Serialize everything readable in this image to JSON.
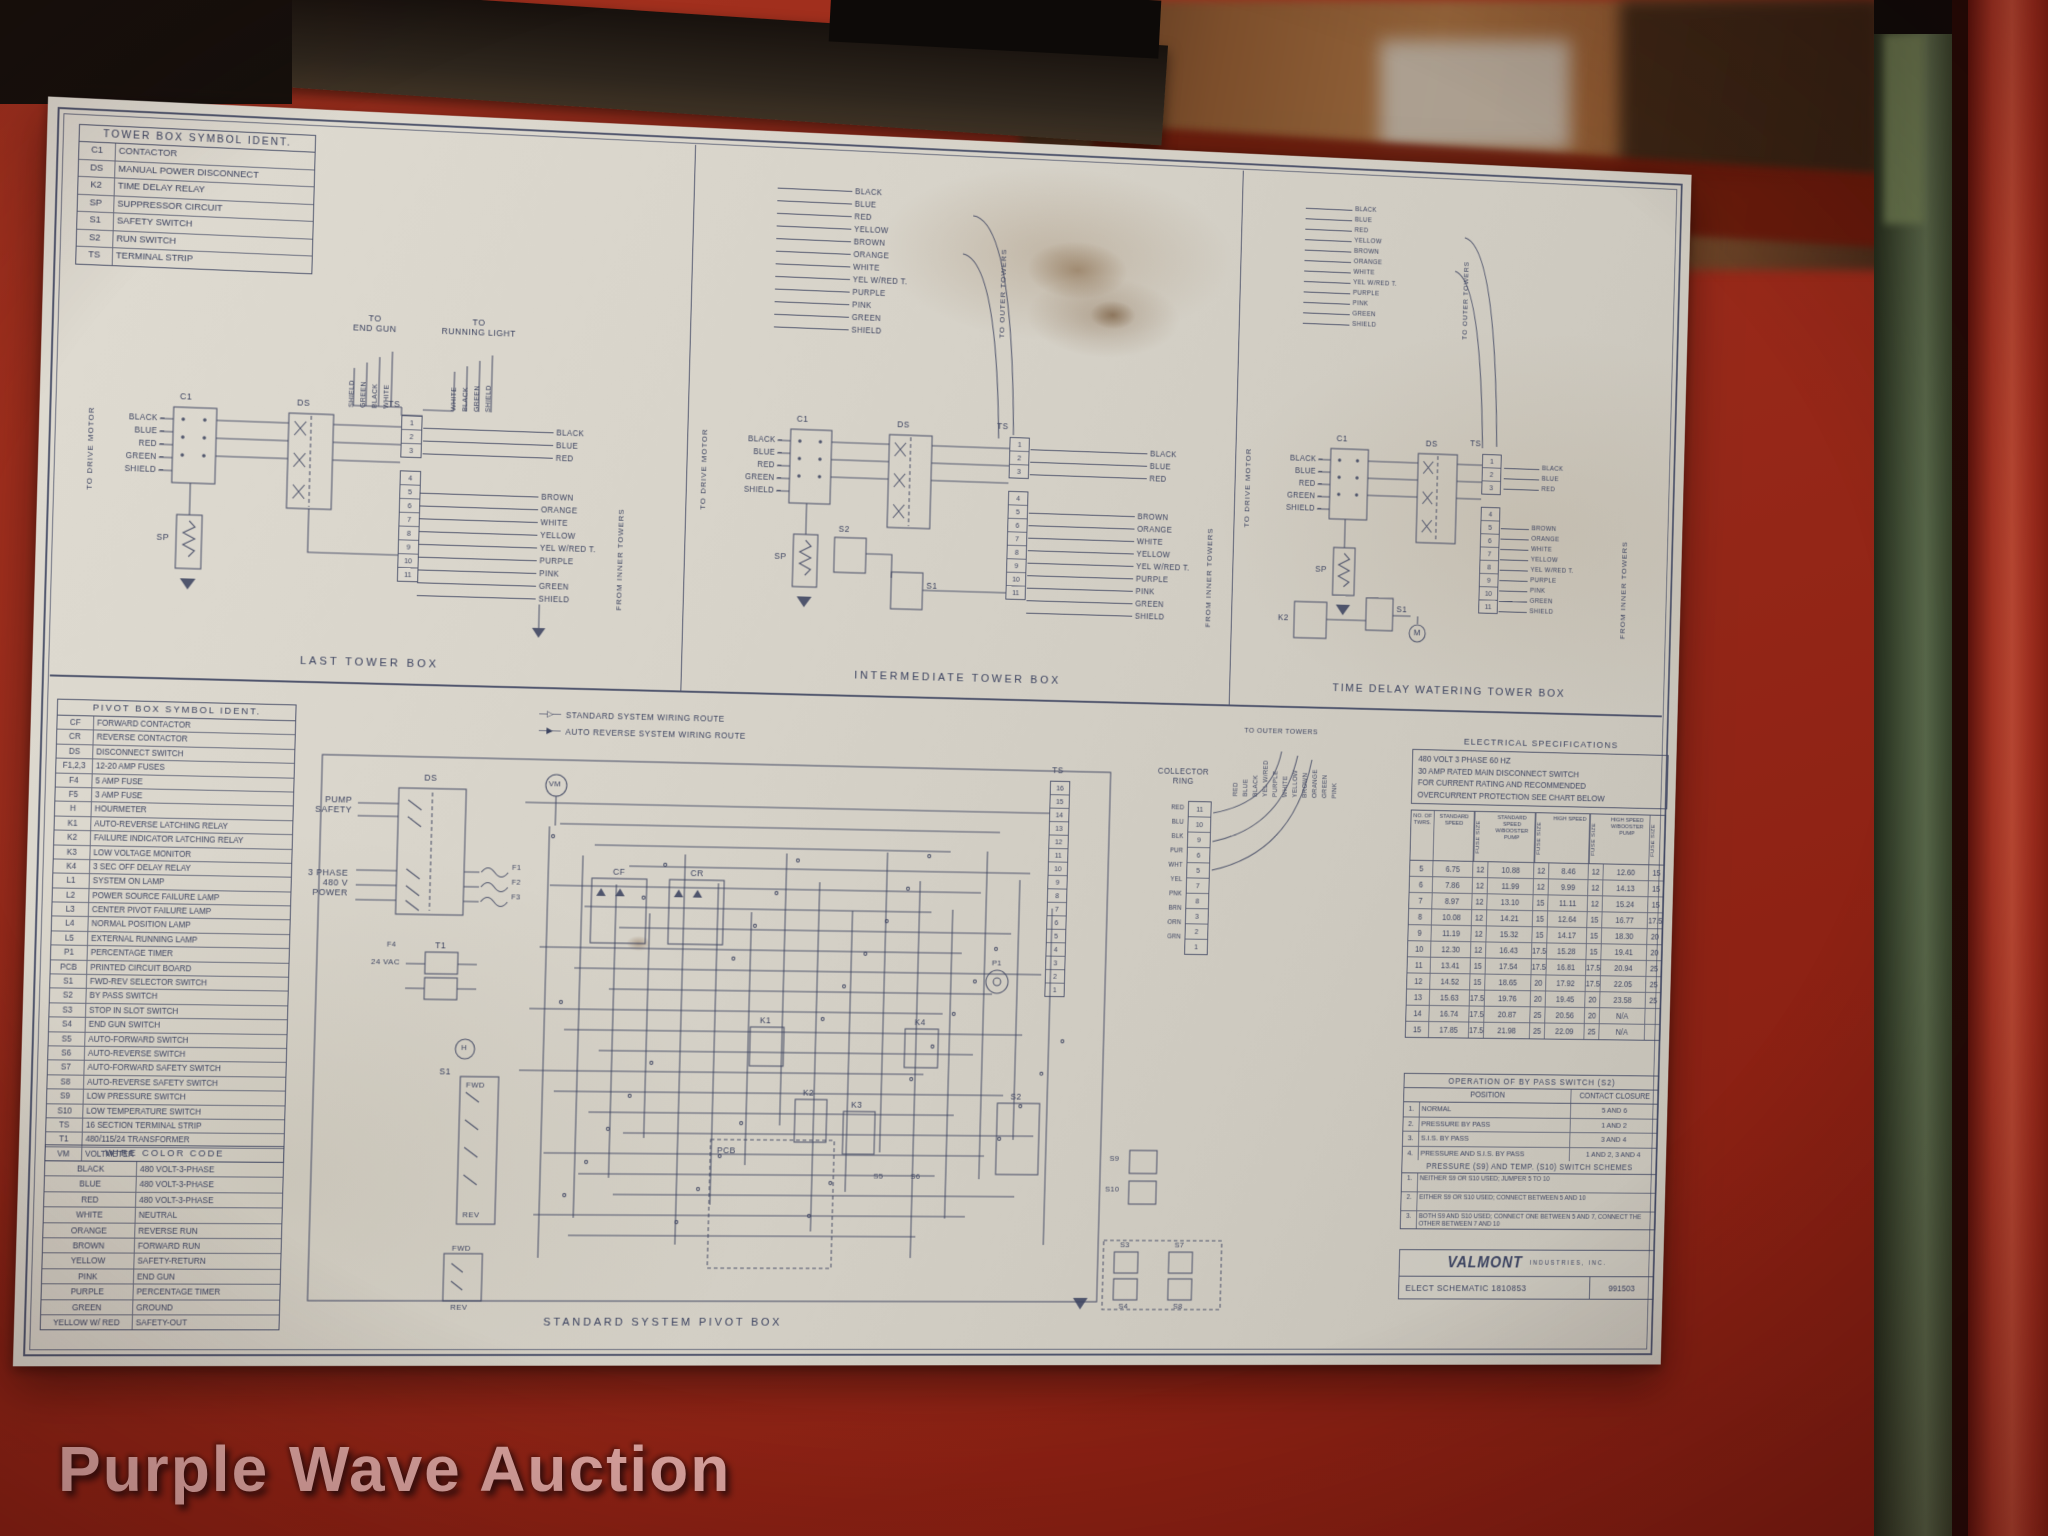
{
  "watermark": "Purple Wave Auction",
  "tower_symbol_table": {
    "title": "TOWER BOX SYMBOL IDENT.",
    "rows": [
      [
        "C1",
        "CONTACTOR"
      ],
      [
        "DS",
        "MANUAL POWER DISCONNECT"
      ],
      [
        "K2",
        "TIME DELAY RELAY"
      ],
      [
        "SP",
        "SUPPRESSOR CIRCUIT"
      ],
      [
        "S1",
        "SAFETY SWITCH"
      ],
      [
        "S2",
        "RUN SWITCH"
      ],
      [
        "TS",
        "TERMINAL STRIP"
      ]
    ]
  },
  "pivot_symbol_table": {
    "title": "PIVOT BOX SYMBOL IDENT.",
    "rows": [
      [
        "CF",
        "FORWARD CONTACTOR"
      ],
      [
        "CR",
        "REVERSE CONTACTOR"
      ],
      [
        "DS",
        "DISCONNECT SWITCH"
      ],
      [
        "F1,2,3",
        "12-20 AMP FUSES"
      ],
      [
        "F4",
        "5 AMP FUSE"
      ],
      [
        "F5",
        "3 AMP FUSE"
      ],
      [
        "H",
        "HOURMETER"
      ],
      [
        "K1",
        "AUTO-REVERSE LATCHING RELAY"
      ],
      [
        "K2",
        "FAILURE INDICATOR LATCHING RELAY"
      ],
      [
        "K3",
        "LOW VOLTAGE MONITOR"
      ],
      [
        "K4",
        "3 SEC OFF DELAY RELAY"
      ],
      [
        "L1",
        "SYSTEM ON LAMP"
      ],
      [
        "L2",
        "POWER SOURCE FAILURE LAMP"
      ],
      [
        "L3",
        "CENTER PIVOT FAILURE LAMP"
      ],
      [
        "L4",
        "NORMAL POSITION LAMP"
      ],
      [
        "L5",
        "EXTERNAL RUNNING LAMP"
      ],
      [
        "P1",
        "PERCENTAGE TIMER"
      ],
      [
        "PCB",
        "PRINTED CIRCUIT BOARD"
      ],
      [
        "S1",
        "FWD-REV SELECTOR SWITCH"
      ],
      [
        "S2",
        "BY PASS SWITCH"
      ],
      [
        "S3",
        "STOP IN SLOT SWITCH"
      ],
      [
        "S4",
        "END GUN SWITCH"
      ],
      [
        "S5",
        "AUTO-FORWARD SWITCH"
      ],
      [
        "S6",
        "AUTO-REVERSE SWITCH"
      ],
      [
        "S7",
        "AUTO-FORWARD SAFETY SWITCH"
      ],
      [
        "S8",
        "AUTO-REVERSE SAFETY SWITCH"
      ],
      [
        "S9",
        "LOW PRESSURE SWITCH"
      ],
      [
        "S10",
        "LOW TEMPERATURE SWITCH"
      ],
      [
        "TS",
        "16 SECTION TERMINAL STRIP"
      ],
      [
        "T1",
        "480/115/24 TRANSFORMER"
      ],
      [
        "VM",
        "VOLTMETER"
      ]
    ]
  },
  "wire_color_table": {
    "title": "WIRE COLOR CODE",
    "rows": [
      [
        "BLACK",
        "480 VOLT-3-PHASE"
      ],
      [
        "BLUE",
        "480 VOLT-3-PHASE"
      ],
      [
        "RED",
        "480 VOLT-3-PHASE"
      ],
      [
        "WHITE",
        "NEUTRAL"
      ],
      [
        "ORANGE",
        "REVERSE RUN"
      ],
      [
        "BROWN",
        "FORWARD RUN"
      ],
      [
        "YELLOW",
        "SAFETY-RETURN"
      ],
      [
        "PINK",
        "END GUN"
      ],
      [
        "PURPLE",
        "PERCENTAGE TIMER"
      ],
      [
        "GREEN",
        "GROUND"
      ],
      [
        "YELLOW W/ RED",
        "SAFETY-OUT"
      ]
    ]
  },
  "d1": {
    "caption": "LAST TOWER BOX",
    "to_drive_motor": "TO DRIVE MOTOR",
    "motor_wires": [
      "BLACK",
      "BLUE",
      "RED",
      "GREEN",
      "SHIELD"
    ],
    "c1": "C1",
    "ds": "DS",
    "ts": "TS",
    "sp": "SP",
    "to_end_gun": "TO\nEND GUN",
    "end_gun_wires": [
      "SHIELD",
      "GREEN",
      "BLACK",
      "WHITE"
    ],
    "to_running_light": "TO\nRUNNING LIGHT",
    "running_light_wires": [
      "WHITE",
      "BLACK",
      "GREEN",
      "SHIELD"
    ],
    "ts_top": [
      "1",
      "2",
      "3"
    ],
    "ts_bottom": [
      "4",
      "5",
      "6",
      "7",
      "8",
      "9",
      "10",
      "11"
    ],
    "phase_wires": [
      "BLACK",
      "BLUE",
      "RED"
    ],
    "tower_wires": [
      "BROWN",
      "ORANGE",
      "WHITE",
      "YELLOW",
      "YEL W/RED T.",
      "PURPLE",
      "PINK",
      "GREEN",
      "SHIELD"
    ],
    "from_inner_towers": "FROM INNER TOWERS"
  },
  "d2": {
    "caption": "INTERMEDIATE TOWER BOX",
    "to_drive_motor": "TO DRIVE MOTOR",
    "motor_wires": [
      "BLACK",
      "BLUE",
      "RED",
      "GREEN",
      "SHIELD"
    ],
    "c1": "C1",
    "ds": "DS",
    "ts": "TS",
    "sp": "SP",
    "s1": "S1",
    "s2": "S2",
    "outer_wires": [
      "BLACK",
      "BLUE",
      "RED",
      "YELLOW",
      "BROWN",
      "ORANGE",
      "WHITE",
      "YEL W/RED T.",
      "PURPLE",
      "PINK",
      "GREEN",
      "SHIELD"
    ],
    "to_outer_towers": "TO OUTER TOWERS",
    "ts_top": [
      "1",
      "2",
      "3"
    ],
    "ts_bottom": [
      "4",
      "5",
      "6",
      "7",
      "8",
      "9",
      "10",
      "11"
    ],
    "phase_wires": [
      "BLACK",
      "BLUE",
      "RED"
    ],
    "tower_wires": [
      "BROWN",
      "ORANGE",
      "WHITE",
      "YELLOW",
      "YEL W/RED T.",
      "PURPLE",
      "PINK",
      "GREEN",
      "SHIELD"
    ],
    "from_inner_towers": "FROM INNER TOWERS"
  },
  "d3": {
    "caption": "TIME DELAY WATERING TOWER BOX",
    "to_drive_motor": "TO DRIVE MOTOR",
    "motor_wires": [
      "BLACK",
      "BLUE",
      "RED",
      "GREEN",
      "SHIELD"
    ],
    "c1": "C1",
    "ds": "DS",
    "ts": "TS",
    "sp": "SP",
    "s1": "S1",
    "k2": "K2",
    "m": "M",
    "outer_wires": [
      "BLACK",
      "BLUE",
      "RED",
      "YELLOW",
      "BROWN",
      "ORANGE",
      "WHITE",
      "YEL W/RED T.",
      "PURPLE",
      "PINK",
      "GREEN",
      "SHIELD"
    ],
    "to_outer_towers": "TO OUTER TOWERS",
    "ts_top": [
      "1",
      "2",
      "3"
    ],
    "ts_bottom": [
      "4",
      "5",
      "6",
      "7",
      "8",
      "9",
      "10",
      "11"
    ],
    "phase_wires": [
      "BLACK",
      "BLUE",
      "RED"
    ],
    "tower_wires": [
      "BROWN",
      "ORANGE",
      "WHITE",
      "YELLOW",
      "YEL W/RED T.",
      "PURPLE",
      "PINK",
      "GREEN",
      "SHIELD"
    ],
    "from_inner_towers": "FROM INNER TOWERS"
  },
  "pv": {
    "caption": "STANDARD SYSTEM PIVOT BOX",
    "legend_std": "STANDARD SYSTEM WIRING ROUTE",
    "legend_auto": "AUTO REVERSE SYSTEM WIRING ROUTE",
    "pump_safety": "PUMP\nSAFETY",
    "power": "3 PHASE\n480 V\nPOWER",
    "ds": "DS",
    "f1": "F1",
    "f2": "F2",
    "f3": "F3",
    "f4": "F4",
    "vm": "VM",
    "cf": "CF",
    "cr": "CR",
    "t1": "T1",
    "vac24": "24 VAC",
    "h": "H",
    "s1": "S1",
    "fwd": "FWD",
    "rev": "REV",
    "pcb": "PCB",
    "k1": "K1",
    "k2": "K2",
    "k3": "K3",
    "k4": "K4",
    "p1": "P1",
    "s2": "S2",
    "s3": "S3",
    "s4": "S4",
    "s5": "S5",
    "s6": "S6",
    "s7": "S7",
    "s8": "S8",
    "s9": "S9",
    "s10": "S10",
    "ts": "TS",
    "collector": "COLLECTOR\nRING",
    "collector_wires": [
      "RED",
      "BLU",
      "BLK",
      "PUR",
      "WHT",
      "YEL",
      "PNK",
      "BRN",
      "ORN",
      "GRN"
    ],
    "collector_terms": [
      "11",
      "10",
      "9",
      "6",
      "5",
      "7",
      "8",
      "3",
      "2",
      "1"
    ],
    "ts_numbers": [
      "16",
      "15",
      "14",
      "13",
      "12",
      "11",
      "10",
      "9",
      "8",
      "7",
      "6",
      "5",
      "4",
      "3",
      "2",
      "1"
    ],
    "to_outer_towers": "TO OUTER TOWERS",
    "outer_wires": [
      "RED",
      "BLUE",
      "BLACK",
      "YEL W/RED",
      "PURPLE",
      "WHITE",
      "YELLOW",
      "BROWN",
      "ORANGE",
      "GREEN",
      "PINK"
    ]
  },
  "specs": {
    "title": "ELECTRICAL SPECIFICATIONS",
    "lines": [
      "480 VOLT 3 PHASE 60 HZ",
      "30 AMP RATED MAIN DISCONNECT SWITCH",
      "FOR CURRENT RATING AND RECOMMENDED",
      "OVERCURRENT PROTECTION SEE CHART BELOW"
    ],
    "col_headers": [
      "NO. OF TWRS.",
      "STANDARD SPEED",
      "FUSE SIZE",
      "STANDARD SPEED W/BOOSTER PUMP",
      "FUSE SIZE",
      "HIGH SPEED",
      "FUSE SIZE",
      "HIGH SPEED W/BOOSTER PUMP",
      "FUSE SIZE"
    ],
    "rows": [
      [
        "5",
        "6.75",
        "12",
        "10.88",
        "12",
        "8.46",
        "12",
        "12.60",
        "15"
      ],
      [
        "6",
        "7.86",
        "12",
        "11.99",
        "12",
        "9.99",
        "12",
        "14.13",
        "15"
      ],
      [
        "7",
        "8.97",
        "12",
        "13.10",
        "15",
        "11.11",
        "12",
        "15.24",
        "15"
      ],
      [
        "8",
        "10.08",
        "12",
        "14.21",
        "15",
        "12.64",
        "15",
        "16.77",
        "17.5"
      ],
      [
        "9",
        "11.19",
        "12",
        "15.32",
        "15",
        "14.17",
        "15",
        "18.30",
        "20"
      ],
      [
        "10",
        "12.30",
        "12",
        "16.43",
        "17.5",
        "15.28",
        "15",
        "19.41",
        "20"
      ],
      [
        "11",
        "13.41",
        "15",
        "17.54",
        "17.5",
        "16.81",
        "17.5",
        "20.94",
        "25"
      ],
      [
        "12",
        "14.52",
        "15",
        "18.65",
        "20",
        "17.92",
        "17.5",
        "22.05",
        "25"
      ],
      [
        "13",
        "15.63",
        "17.5",
        "19.76",
        "20",
        "19.45",
        "20",
        "23.58",
        "25"
      ],
      [
        "14",
        "16.74",
        "17.5",
        "20.87",
        "25",
        "20.56",
        "20",
        "N/A",
        ""
      ],
      [
        "15",
        "17.85",
        "17.5",
        "21.98",
        "25",
        "22.09",
        "25",
        "N/A",
        ""
      ]
    ]
  },
  "bypass": {
    "title": "OPERATION OF BY PASS SWITCH (S2)",
    "headers": [
      "POSITION",
      "CONTACT CLOSURE"
    ],
    "rows": [
      [
        "1.",
        "NORMAL",
        "5 AND 6"
      ],
      [
        "2.",
        "PRESSURE BY PASS",
        "1 AND 2"
      ],
      [
        "3.",
        "S.I.S. BY PASS",
        "3 AND 4"
      ],
      [
        "4.",
        "PRESSURE AND S.I.S. BY PASS",
        "1 AND 2, 3 AND 4"
      ]
    ],
    "schemes_title": "PRESSURE (S9) AND TEMP. (S10) SWITCH SCHEMES",
    "schemes": [
      [
        "1.",
        "NEITHER S9 OR S10 USED; JUMPER 5 TO 10"
      ],
      [
        "2.",
        "EITHER S9 OR S10 USED; CONNECT BETWEEN 5 AND 10"
      ],
      [
        "3.",
        "BOTH S9 AND S10 USED; CONNECT ONE BETWEEN 5 AND 7, CONNECT THE OTHER BETWEEN 7 AND 10"
      ]
    ]
  },
  "title_block": {
    "brand": "VALMONT",
    "brand_suffix": "INDUSTRIES, INC.",
    "doc": "ELECT SCHEMATIC 1810853",
    "code": "991503"
  }
}
